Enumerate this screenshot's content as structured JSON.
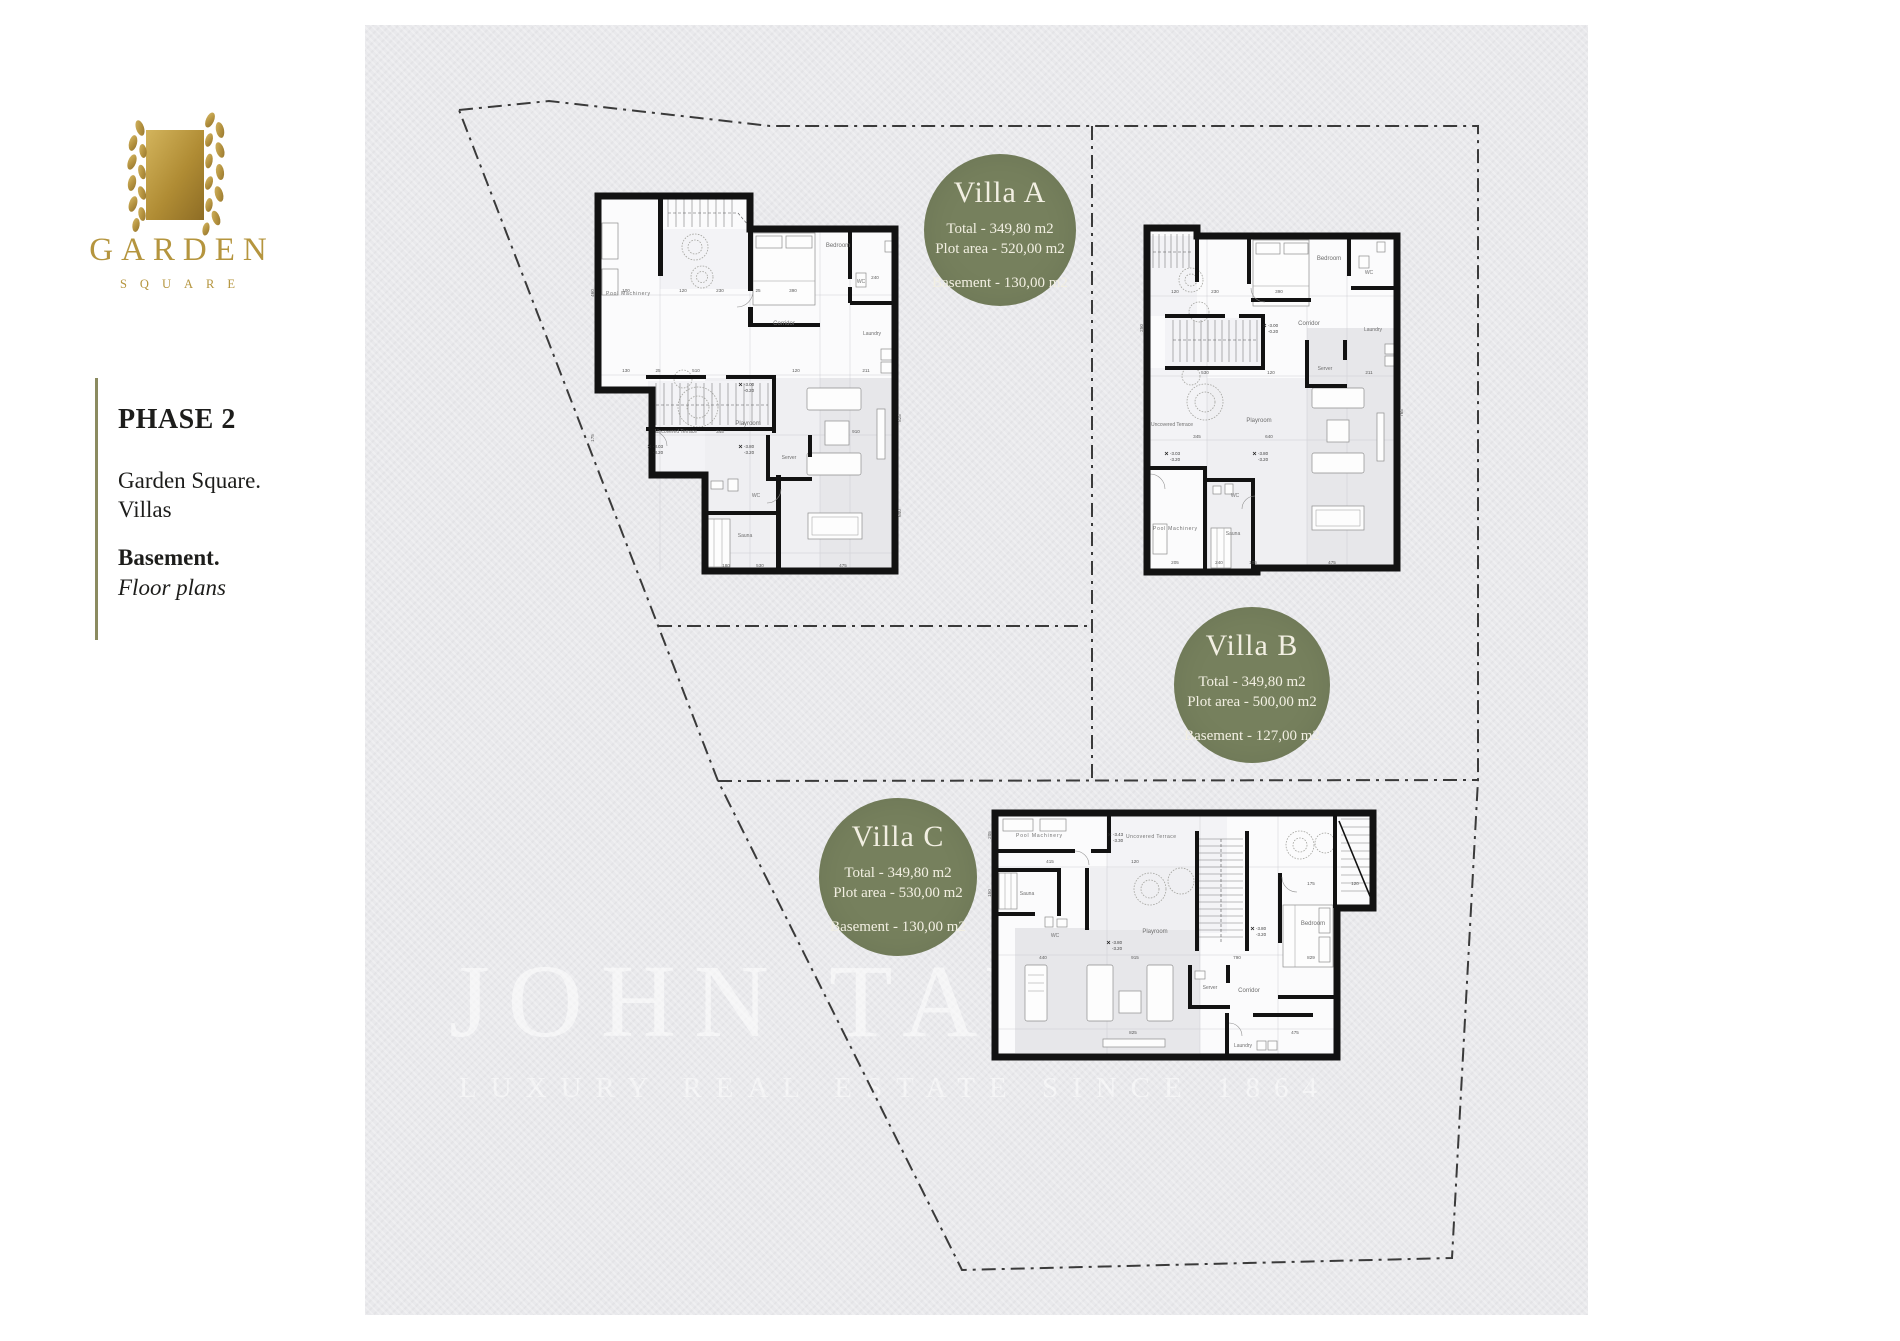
{
  "logo": {
    "name": "GARDEN",
    "sub": "SQUARE"
  },
  "sidebar": {
    "phase": "PHASE 2",
    "project_line1": "Garden Square.",
    "project_line2": "Villas",
    "section": "Basement.",
    "subsection": "Floor plans"
  },
  "watermark": {
    "title": "JOHN TAYLOR",
    "subtitle": "LUXURY REAL ESTATE SINCE 1864"
  },
  "badges": {
    "a": {
      "title": "Villa A",
      "total": "Total - 349,80 m2",
      "plot": "Plot area - 520,00 m2",
      "basement": "Basement - 130,00 m2"
    },
    "b": {
      "title": "Villa B",
      "total": "Total - 349,80 m2",
      "plot": "Plot area - 500,00 m2",
      "basement": "Basement - 127,00 m2"
    },
    "c": {
      "title": "Villa C",
      "total": "Total - 349,80 m2",
      "plot": "Plot area - 530,00 m2",
      "basement": "Basement - 130,00 m2"
    }
  },
  "colors": {
    "badge_green": "#76805d",
    "gold": "#b5953e",
    "canvas_gray": "#e9e9ec",
    "accent_line": "#8b8b60",
    "wall_black": "#121212"
  },
  "plans": {
    "a": {
      "rooms": [
        "Pool Machinery",
        "Bedroom",
        "WC",
        "Corridor",
        "Laundry",
        "Server",
        "Playroom",
        "Uncovered Terrace",
        "WC",
        "Sauna"
      ],
      "dims": [
        "100",
        "120",
        "230",
        "390",
        "240",
        "130",
        "510",
        "120",
        "211",
        "345",
        "910",
        "180",
        "530",
        "475",
        "460",
        "175",
        "825",
        "640",
        "25"
      ],
      "levels": [
        "-3.00",
        "-0.20",
        "-3.03",
        "-3.20",
        "-3.80",
        "-3.20"
      ]
    },
    "b": {
      "rooms": [
        "Bedroom",
        "WC",
        "Corridor",
        "Laundry",
        "Server",
        "Playroom",
        "Uncovered Terrace",
        "Pool Machinery",
        "Sauna",
        "WC"
      ],
      "dims": [
        "120",
        "230",
        "390",
        "530",
        "120",
        "211",
        "345",
        "640",
        "205",
        "240",
        "105",
        "475",
        "765",
        "250"
      ],
      "levels": [
        "-3.00",
        "-0.20",
        "-3.03",
        "-3.20",
        "-3.80",
        "-3.20"
      ]
    },
    "c": {
      "rooms": [
        "Pool Machinery",
        "Uncovered Terrace",
        "Sauna",
        "WC",
        "Playroom",
        "Bedroom",
        "Server",
        "Corridor",
        "Laundry"
      ],
      "dims": [
        "415",
        "120",
        "175",
        "120",
        "440",
        "915",
        "790",
        "829",
        "825",
        "475",
        "205",
        "150"
      ],
      "levels": [
        "-3.43",
        "-3.30",
        "-3.80",
        "-3.20",
        "-3.80",
        "-3.20"
      ]
    }
  }
}
